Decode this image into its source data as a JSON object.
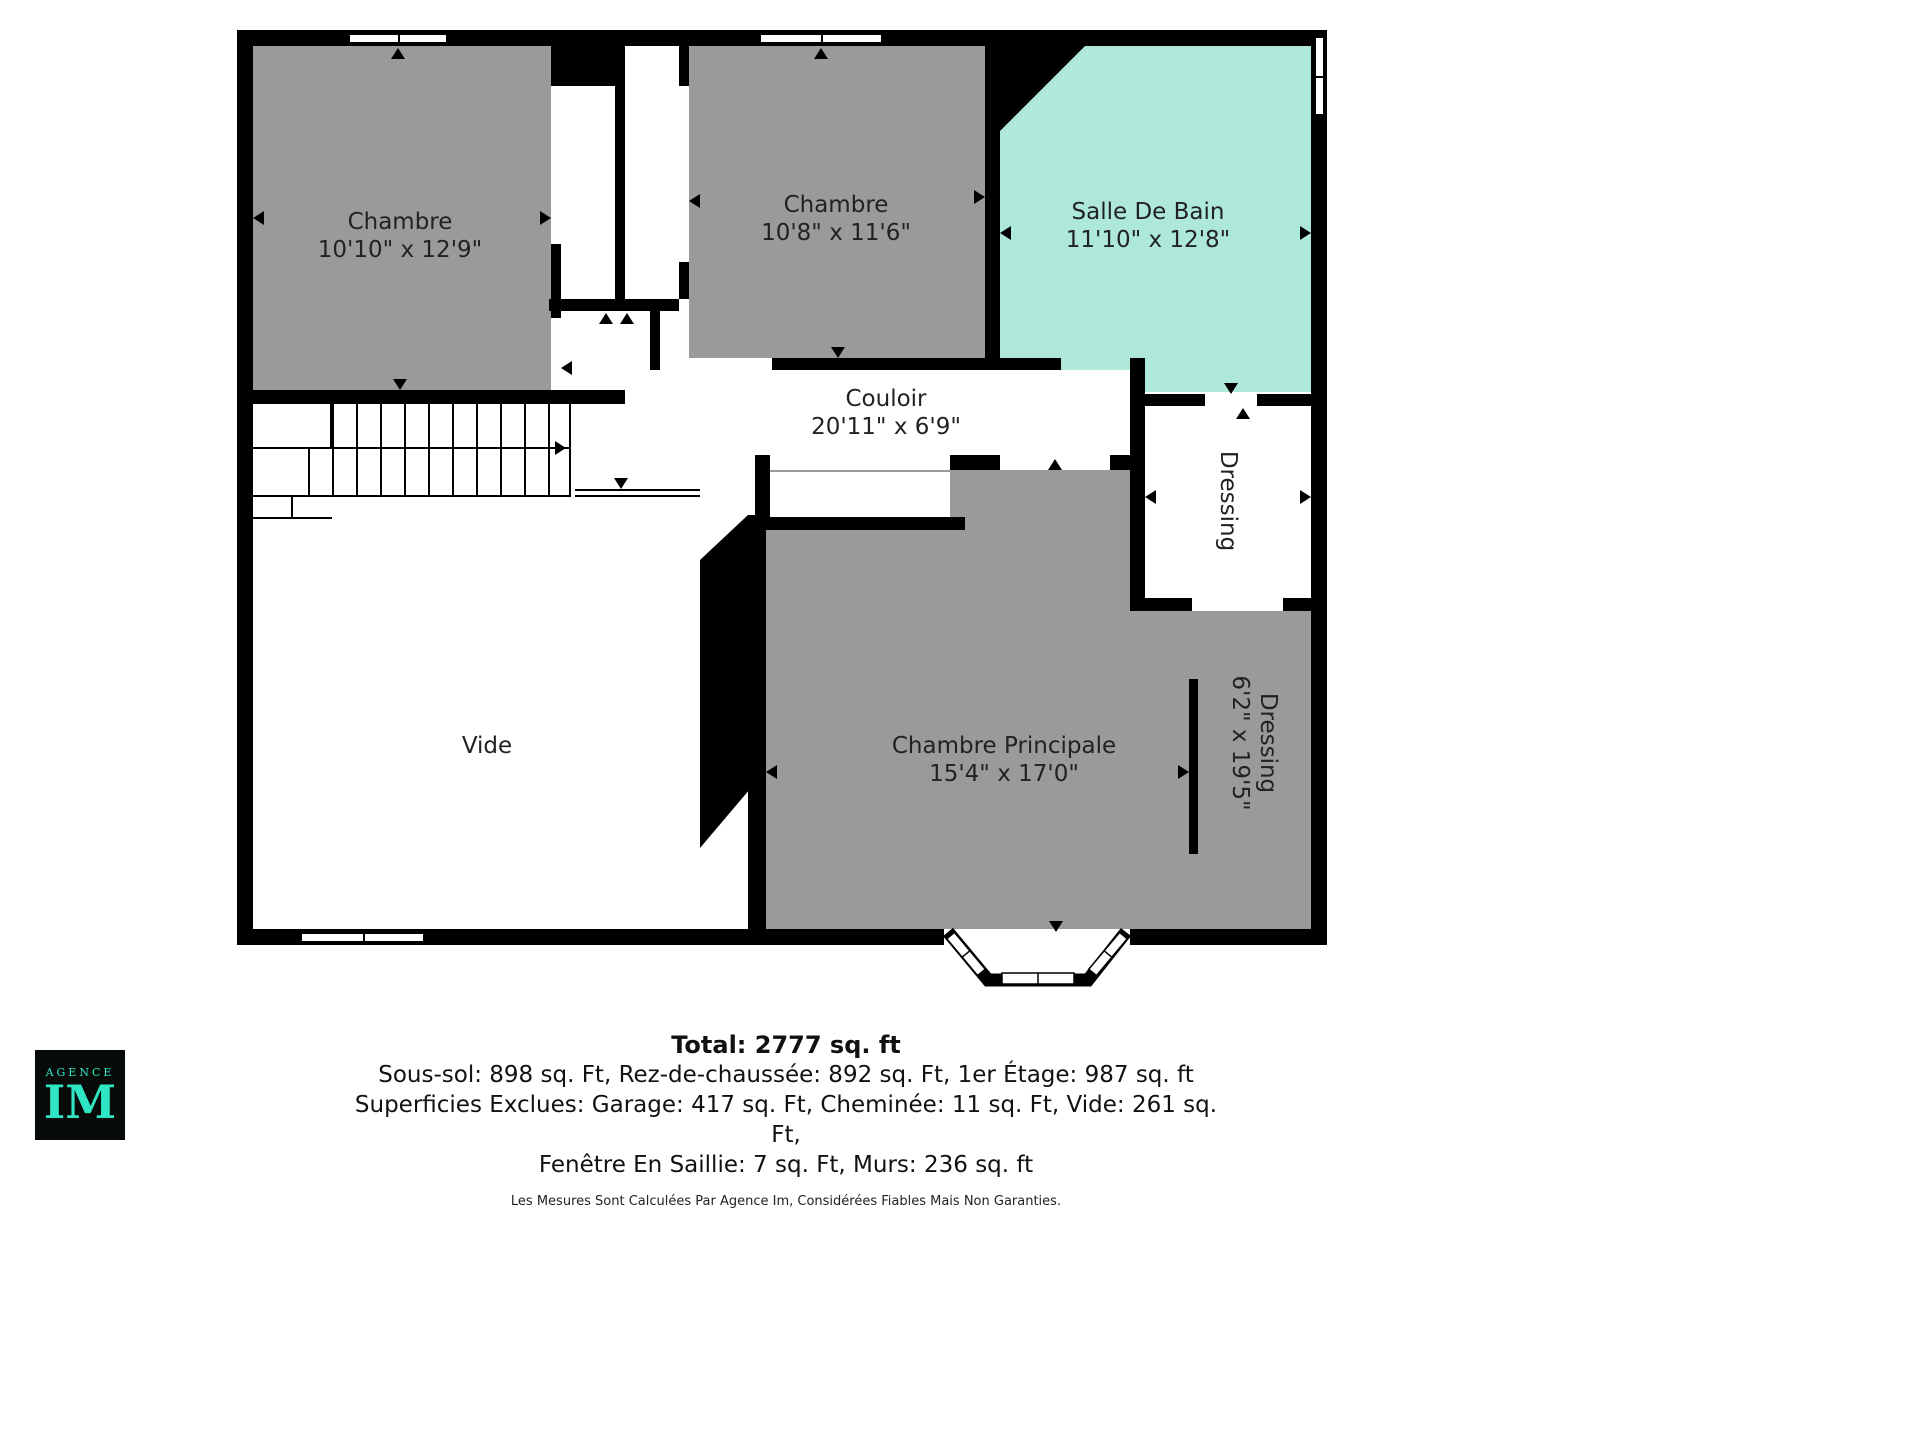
{
  "plan": {
    "colors": {
      "room_gray": "#9a9a9a",
      "bathroom_teal": "#ade8da",
      "wall_black": "#000000",
      "logo_teal": "#2ee6c4"
    },
    "icons": {
      "door-arrow": "black triangle marker",
      "window": "white band with black frame"
    },
    "rooms": {
      "chambre1": {
        "name": "Chambre",
        "dims": "10'10\" x 12'9\""
      },
      "chambre2": {
        "name": "Chambre",
        "dims": "10'8\" x 11'6\""
      },
      "salle_de_bain": {
        "name": "Salle De Bain",
        "dims": "11'10\" x 12'8\""
      },
      "couloir": {
        "name": "Couloir",
        "dims": "20'11\" x 6'9\""
      },
      "dressing_haut": {
        "name": "Dressing"
      },
      "vide": {
        "name": "Vide"
      },
      "chambre_principale": {
        "name": "Chambre Principale",
        "dims": "15'4\" x 17'0\""
      },
      "dressing_bas": {
        "name": "Dressing",
        "dims": "6'2\" x 19'5\""
      }
    }
  },
  "legend": {
    "total": "Total: 2777 sq. ft",
    "line1": "Sous-sol: 898 sq. Ft, Rez-de-chaussée: 892 sq. Ft, 1er Étage: 987 sq. ft",
    "line2": "Superficies Exclues: Garage: 417 sq. Ft, Cheminée: 11 sq. Ft, Vide: 261 sq. Ft,",
    "line3": "Fenêtre En Saillie: 7 sq. Ft, Murs: 236 sq. ft",
    "disclaimer": "Les Mesures Sont Calculées Par Agence Im, Considérées Fiables Mais Non Garanties."
  },
  "logo": {
    "agence": "AGENCE",
    "im": "IM"
  }
}
